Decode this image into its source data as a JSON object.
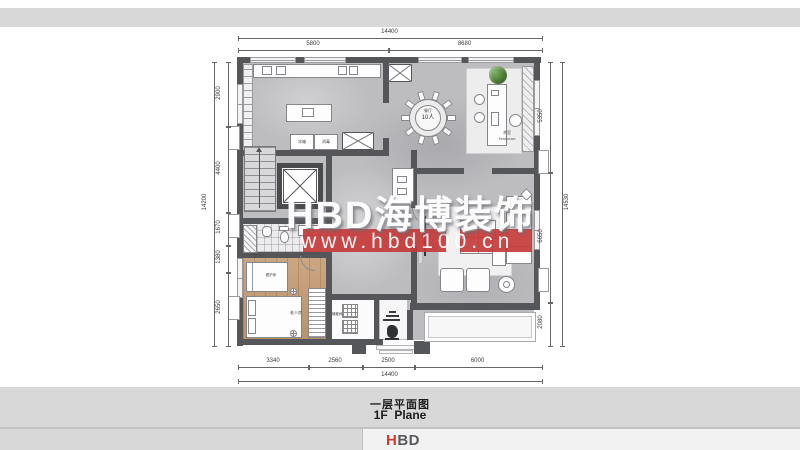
{
  "watermark": {
    "brand": "HBD海博装饰",
    "url": "www.hbd100.cn"
  },
  "caption": {
    "title_zh": "一层平面图",
    "title_en": "1F  Plane"
  },
  "logo": {
    "part1": "H",
    "part2": "BD"
  },
  "colors": {
    "accent_red": "#c5393a",
    "wall_gray": "#55565a",
    "marble_floor": "#bdbdc0",
    "wood_floor": "#c49a70",
    "band_gray": "#d8d8d8",
    "plant_green": "#4c7a36"
  },
  "plan": {
    "dims": {
      "top": {
        "total": "14400",
        "s1": "5800",
        "s2": "8680"
      },
      "bottom": {
        "total": "14400",
        "s1": "3340",
        "s2": "2560",
        "s3": "2500",
        "s4": "6000"
      },
      "left": {
        "total": "14200",
        "s1": "2900",
        "s2": "4400",
        "s3": "1670",
        "s4": "1380",
        "s5": "2650"
      },
      "right": {
        "total": "14530",
        "s1": "5350",
        "s2": "6650",
        "s3": "2080"
      }
    },
    "labels": {
      "dining_zh": "餐厅",
      "dining_cap": "10人",
      "tea_zh": "茶室",
      "tea_en": "Teahouse",
      "living_zh": "客厅",
      "bath_zh": "卫生间",
      "bedroom_zh": "老人房",
      "care_bed_zh": "看护床",
      "storage_zh": "储藏间",
      "fridge_zh": "冰箱",
      "sterilizer_zh": "消毒"
    }
  }
}
